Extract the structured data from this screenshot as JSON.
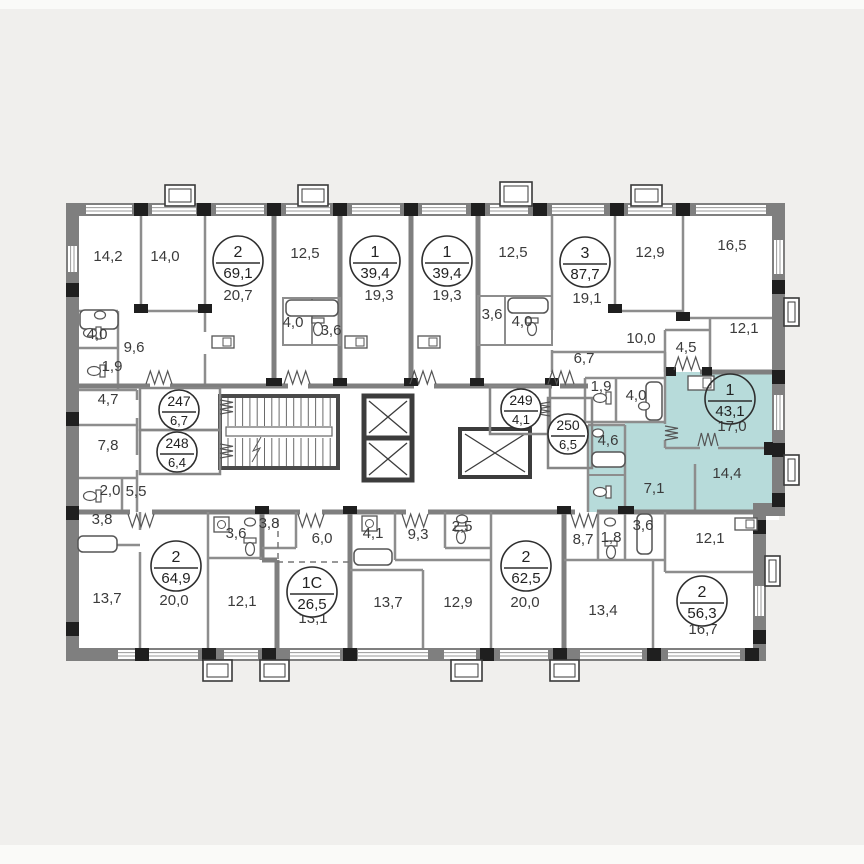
{
  "plan": {
    "type": "residential-floor-plan",
    "highlight_color": "#b7dbda",
    "wall_color": "#7f7f7f",
    "accent_color": "#1f1f1f",
    "background_color": "#f0efed",
    "apartments": [
      {
        "number": "2",
        "area": "69,1",
        "x": 238,
        "y": 261,
        "size": "large",
        "highlighted": false
      },
      {
        "number": "1",
        "area": "39,4",
        "x": 375,
        "y": 261,
        "size": "large",
        "highlighted": false
      },
      {
        "number": "1",
        "area": "39,4",
        "x": 447,
        "y": 261,
        "size": "large",
        "highlighted": false
      },
      {
        "number": "3",
        "area": "87,7",
        "x": 585,
        "y": 262,
        "size": "large",
        "highlighted": false
      },
      {
        "number": "247",
        "area": "6,7",
        "x": 179,
        "y": 410,
        "size": "small",
        "highlighted": false
      },
      {
        "number": "248",
        "area": "6,4",
        "x": 177,
        "y": 452,
        "size": "small",
        "highlighted": false
      },
      {
        "number": "249",
        "area": "4,1",
        "x": 521,
        "y": 409,
        "size": "small",
        "highlighted": false
      },
      {
        "number": "250",
        "area": "6,5",
        "x": 568,
        "y": 434,
        "size": "small",
        "highlighted": false
      },
      {
        "number": "1",
        "area": "43,1",
        "x": 730,
        "y": 399,
        "size": "large",
        "highlighted": true
      },
      {
        "number": "2",
        "area": "64,9",
        "x": 176,
        "y": 566,
        "size": "large",
        "highlighted": false
      },
      {
        "number": "1C",
        "area": "26,5",
        "x": 312,
        "y": 592,
        "size": "large",
        "highlighted": false
      },
      {
        "number": "2",
        "area": "62,5",
        "x": 526,
        "y": 566,
        "size": "large",
        "highlighted": false
      },
      {
        "number": "2",
        "area": "56,3",
        "x": 702,
        "y": 601,
        "size": "large",
        "highlighted": false
      }
    ],
    "rooms": [
      {
        "area": "14,2",
        "x": 108,
        "y": 261
      },
      {
        "area": "14,0",
        "x": 165,
        "y": 261
      },
      {
        "area": "20,7",
        "x": 238,
        "y": 300
      },
      {
        "area": "4,0",
        "x": 97,
        "y": 339
      },
      {
        "area": "9,6",
        "x": 134,
        "y": 352
      },
      {
        "area": "1,9",
        "x": 112,
        "y": 371
      },
      {
        "area": "4,7",
        "x": 108,
        "y": 404
      },
      {
        "area": "12,5",
        "x": 305,
        "y": 258
      },
      {
        "area": "4,0",
        "x": 293,
        "y": 327
      },
      {
        "area": "3,6",
        "x": 331,
        "y": 335
      },
      {
        "area": "19,3",
        "x": 379,
        "y": 300
      },
      {
        "area": "19,3",
        "x": 447,
        "y": 300
      },
      {
        "area": "3,6",
        "x": 492,
        "y": 319
      },
      {
        "area": "4,0",
        "x": 522,
        "y": 326
      },
      {
        "area": "12,5",
        "x": 513,
        "y": 257
      },
      {
        "area": "19,1",
        "x": 587,
        "y": 303
      },
      {
        "area": "6,7",
        "x": 584,
        "y": 363
      },
      {
        "area": "1,9",
        "x": 601,
        "y": 391
      },
      {
        "area": "4,0",
        "x": 636,
        "y": 400
      },
      {
        "area": "12,9",
        "x": 650,
        "y": 257
      },
      {
        "area": "16,5",
        "x": 732,
        "y": 250
      },
      {
        "area": "10,0",
        "x": 641,
        "y": 343
      },
      {
        "area": "4,5",
        "x": 686,
        "y": 352
      },
      {
        "area": "12,1",
        "x": 744,
        "y": 333
      },
      {
        "area": "17,0",
        "x": 732,
        "y": 431
      },
      {
        "area": "14,4",
        "x": 727,
        "y": 478
      },
      {
        "area": "4,6",
        "x": 608,
        "y": 445
      },
      {
        "area": "7,1",
        "x": 654,
        "y": 493
      },
      {
        "area": "7,8",
        "x": 108,
        "y": 450
      },
      {
        "area": "2,0",
        "x": 110,
        "y": 495
      },
      {
        "area": "5,5",
        "x": 136,
        "y": 496
      },
      {
        "area": "3,8",
        "x": 102,
        "y": 524
      },
      {
        "area": "13,7",
        "x": 107,
        "y": 603
      },
      {
        "area": "20,0",
        "x": 174,
        "y": 605
      },
      {
        "area": "12,1",
        "x": 242,
        "y": 606
      },
      {
        "area": "3,6",
        "x": 236,
        "y": 538
      },
      {
        "area": "3,8",
        "x": 269,
        "y": 528
      },
      {
        "area": "6,0",
        "x": 322,
        "y": 543
      },
      {
        "area": "13,1",
        "x": 313,
        "y": 623
      },
      {
        "area": "4,1",
        "x": 373,
        "y": 538
      },
      {
        "area": "9,3",
        "x": 418,
        "y": 539
      },
      {
        "area": "2,5",
        "x": 462,
        "y": 531
      },
      {
        "area": "13,7",
        "x": 388,
        "y": 607
      },
      {
        "area": "12,9",
        "x": 458,
        "y": 607
      },
      {
        "area": "20,0",
        "x": 525,
        "y": 607
      },
      {
        "area": "8,7",
        "x": 583,
        "y": 544
      },
      {
        "area": "1,8",
        "x": 611,
        "y": 542
      },
      {
        "area": "3,6",
        "x": 643,
        "y": 530
      },
      {
        "area": "12,1",
        "x": 710,
        "y": 543
      },
      {
        "area": "13,4",
        "x": 603,
        "y": 615
      },
      {
        "area": "16,7",
        "x": 703,
        "y": 634
      }
    ]
  }
}
